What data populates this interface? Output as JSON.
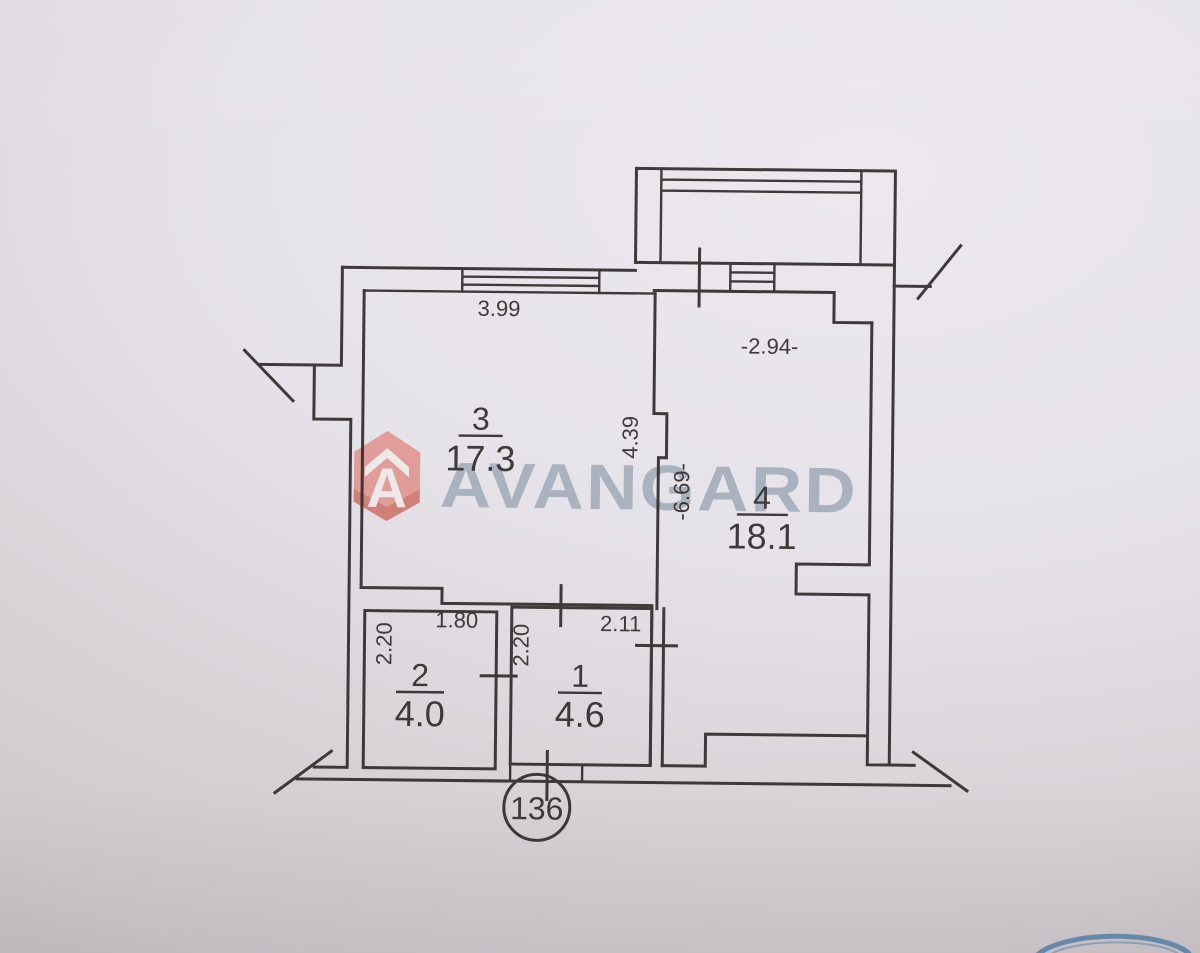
{
  "watermark": {
    "brand": "AVANGARD"
  },
  "plan": {
    "rooms": {
      "r3": {
        "number": "3",
        "area": "17.3"
      },
      "r4": {
        "number": "4",
        "area": "18.1"
      },
      "r2": {
        "number": "2",
        "area": "4.0"
      },
      "r1": {
        "number": "1",
        "area": "4.6"
      }
    },
    "dimensions": {
      "room3_top_width": "3.99",
      "room3_height": "4.39",
      "room4_top_width": "-2.94-",
      "room4_height": "-6.69-",
      "room2_height": "2.20",
      "room2_width": "1.80",
      "room1_height": "2.20",
      "room1_width": "2.11"
    },
    "apartment_number": "136"
  },
  "colors": {
    "ink": "#35302f",
    "watermark_text": "#93a0af",
    "watermark_icon": "#de837b",
    "watermark_icon_dark": "#c95c50",
    "stamp_blue": "#4d7fad",
    "paper_top": "#ece8ee",
    "paper_bottom": "#ccc6c9"
  }
}
